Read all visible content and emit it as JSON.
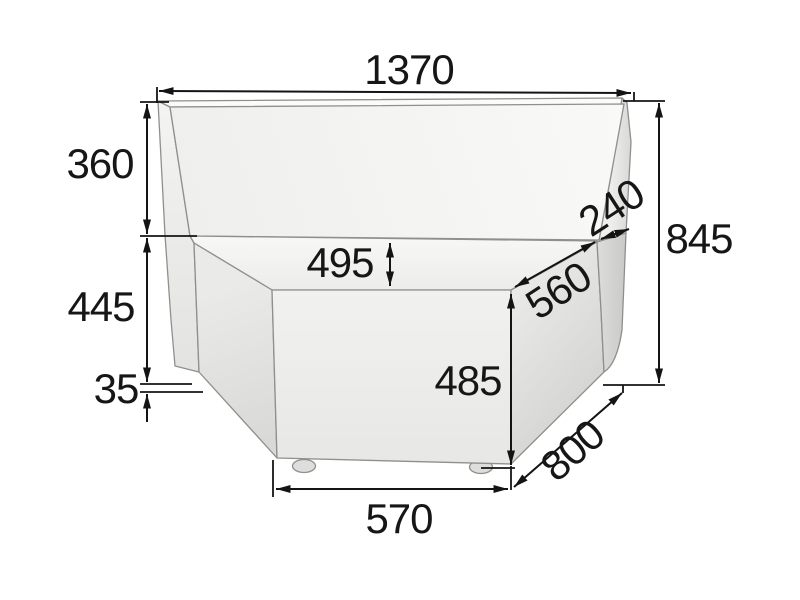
{
  "diagram": {
    "subject": "Corner sofa module - three-quarter view dimension drawing",
    "unit": "mm",
    "line_color": "#141414",
    "upholstery_color_light": "#f7f7f5",
    "upholstery_color_dark": "#c9c9c7",
    "dims": {
      "overall_width": "1370",
      "backrest_height": "360",
      "left_base_height": "445",
      "bottom_clearance": "35",
      "seat_depth_drop": "495",
      "backrest_top_depth": "240",
      "seat_side_edge": "560",
      "overall_height": "845",
      "front_height": "485",
      "side_depth": "800",
      "front_width": "570"
    }
  }
}
